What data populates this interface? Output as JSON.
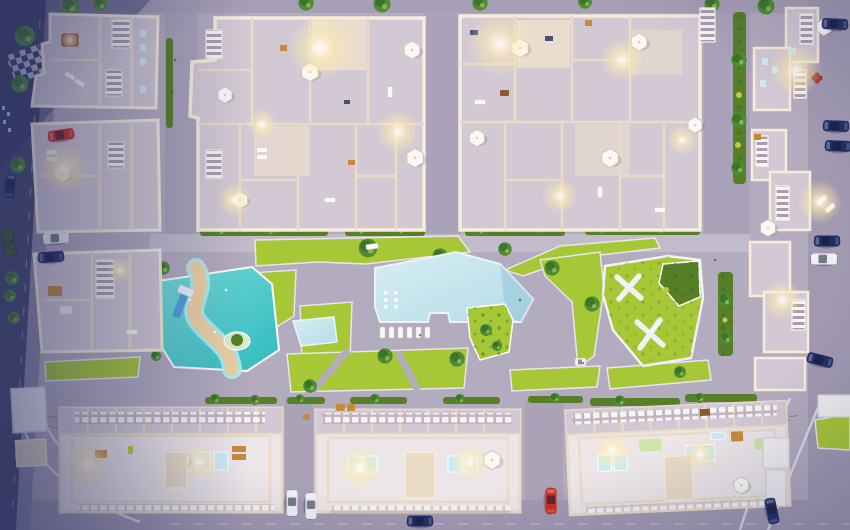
{
  "meta": {
    "title": "Aerial dusk view of a residential complex masterplan 3D render",
    "description": "Top-down architectural visualization at dusk: apartment blocks with lit rooftop terraces surround a central courtyard containing a free-form swimming pool, a children's aqua park with water slide and sand path, lawns, a park with crossing footpaths, hedgerows, trees and perimeter streets with parked cars."
  },
  "palette": {
    "plaza": "#b3abbe",
    "asphalt": "#a29ab1",
    "street_dark": "#43486e",
    "sidewalk": "#8e8aa6",
    "path": "#c4bdcd",
    "curb": "#e9e4ef",
    "wall": "#e9dbc6",
    "wall_hi": "#f7edda",
    "roof": "#d3c9d4",
    "roof_lit": "#f0e2cc",
    "roof_white": "#ece6e8",
    "lawn": "#a6c836",
    "lawn_dark": "#8cb22c",
    "hedge": "#567f28",
    "tree": "#4e8c34",
    "tree_dark": "#2e6420",
    "pool_hi": "#d6edf3",
    "pool": "#b5dce8",
    "pool_deep": "#8fc3d8",
    "aqua_hi": "#7adfdc",
    "aqua": "#2fb9bd",
    "sand": "#eecfa2",
    "skylight": "#cdeaf4",
    "white": "#ffffff",
    "glow": "#ffeaae",
    "dusk": "#2c3260",
    "car_red": "#cf2d20",
    "car_navy": "#202e66",
    "car_white": "#edeff3",
    "tan": "#c9893a",
    "brown": "#8d5a2e",
    "slide_blue": "#4f9fd8",
    "yellow_bush": "#c6c943"
  },
  "scene": {
    "environment": {
      "time_of_day": "dusk",
      "view": "top-down aerial",
      "style": "3D architectural render"
    },
    "amenities": {
      "main_pool": "free-form swimming pool with underwater lights and planted island",
      "kids_aqua_park": "children's water playground with slide and winding sand path",
      "small_pool": "small wading pool",
      "park": "lawn park with white crossing footpaths and hedge garden",
      "pool_loungers": "row of sun loungers at pool edge",
      "landscaping": "lawns, hedgerows, street trees"
    },
    "buildings": {
      "top_left_column": "stepped apartment blocks with pergolas and roof terraces",
      "top_center_clusters": "two clusters of rooftop-terrace apartments with umbrellas and lit terraces",
      "right_column": "apartment blocks with white louvered pergolas",
      "bottom_row": "three linear apartment buildings with white roofs, skylights and balcony rows",
      "service": "small white utility buildings"
    },
    "street_features": {
      "crosswalk": "checker crosswalk at top-left corner",
      "dumpsters": "green waste bins on left street",
      "annotations": "tiny handwritten dimension scribbles"
    },
    "vehicles": {
      "parked_cars": {
        "red": 2,
        "white": 4,
        "dark_blue": 9
      }
    }
  }
}
